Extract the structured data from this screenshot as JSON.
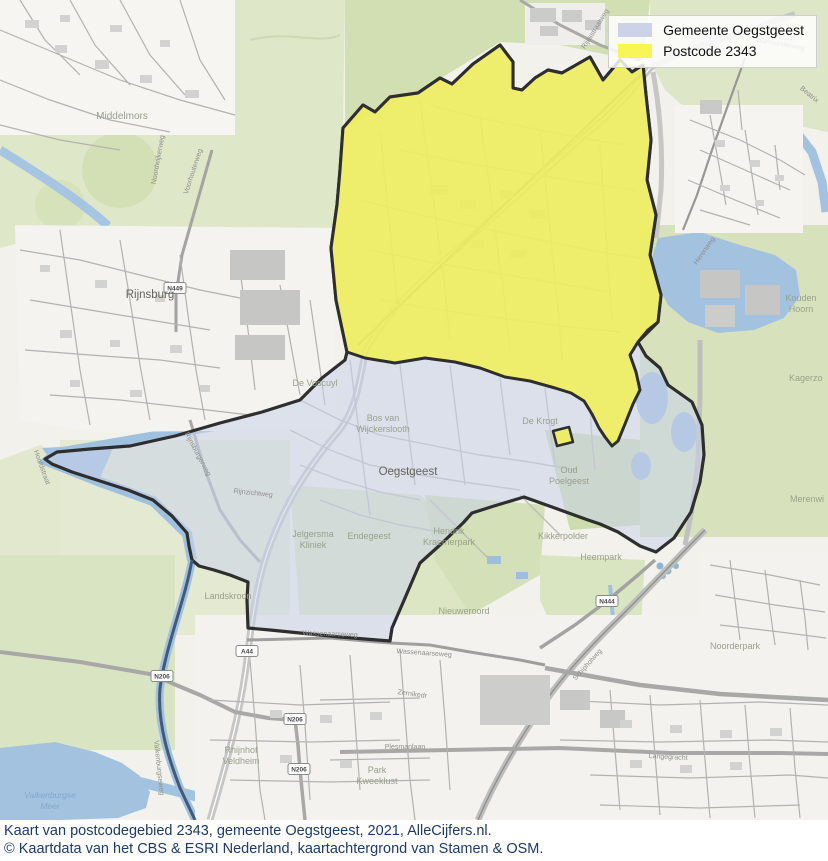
{
  "legend": {
    "items": [
      {
        "label": "Gemeente Oegstgeest",
        "color": "#ccd3e8"
      },
      {
        "label": "Postcode 2343",
        "color": "#f8f655"
      }
    ]
  },
  "caption": {
    "line1": "Kaart van postcodegebied 2343, gemeente Oegstgeest, 2021, AlleCijfers.nl.",
    "line2": "© Kaartdata van het CBS & ESRI Nederland, kaartachtergrond van Stamen & OSM.",
    "color": "#1c3a6a"
  },
  "map": {
    "overlays": {
      "municipality": {
        "name": "Gemeente Oegstgeest",
        "fill": "rgba(201,209,233,0.55)",
        "stroke": "#2e2e2e"
      },
      "postcode": {
        "name": "Postcode 2343",
        "fill": "rgba(244,241,76,0.80)",
        "stroke": "#2e2e2e"
      }
    },
    "labels": [
      {
        "text": "Middelmors"
      },
      {
        "text": "Rijnsburg"
      },
      {
        "text": "Noordwijkerweg"
      },
      {
        "text": "Voorhouterweg"
      },
      {
        "text": "Kouden"
      },
      {
        "text": "Hoorn"
      },
      {
        "text": "Kagerzo"
      },
      {
        "text": "Merenwi"
      },
      {
        "text": "De Voscuyl"
      },
      {
        "text": "Bos van"
      },
      {
        "text": "Wijckerslooth"
      },
      {
        "text": "Oegstgeest"
      },
      {
        "text": "De Krogt"
      },
      {
        "text": "Oud"
      },
      {
        "text": "Poelgeest"
      },
      {
        "text": "Jelgersma"
      },
      {
        "text": "Kliniek"
      },
      {
        "text": "Endegeest"
      },
      {
        "text": "Hendrik"
      },
      {
        "text": "Kraemerpark"
      },
      {
        "text": "Landskroon"
      },
      {
        "text": "Kikkerpolder"
      },
      {
        "text": "Heempark"
      },
      {
        "text": "Nieuweroord"
      },
      {
        "text": "Noorderpark"
      },
      {
        "text": "Rhijnhof"
      },
      {
        "text": "Veldheim"
      },
      {
        "text": "Park"
      },
      {
        "text": "Kweeklust"
      },
      {
        "text": "Plesmanlaan"
      },
      {
        "text": "Valkenburgse"
      },
      {
        "text": "Meer"
      },
      {
        "text": "Rijnsburgerweg"
      },
      {
        "text": "Rijnzichtweg"
      },
      {
        "text": "Herenweg"
      },
      {
        "text": "Rijksstraatweg"
      },
      {
        "text": "Schipholweg"
      },
      {
        "text": "Wassenaarseweg"
      },
      {
        "text": "Wassenaarseweg"
      },
      {
        "text": "Zernikedr"
      },
      {
        "text": "Valkenburgseweg"
      },
      {
        "text": "Hoofdstraat"
      },
      {
        "text": "Warmunderweg"
      },
      {
        "text": "Beatrix"
      },
      {
        "text": "Langegracht"
      }
    ],
    "road_badges": [
      {
        "text": "N449"
      },
      {
        "text": "A44"
      },
      {
        "text": "N444"
      },
      {
        "text": "N206"
      },
      {
        "text": "N206"
      },
      {
        "text": "N206"
      }
    ]
  }
}
